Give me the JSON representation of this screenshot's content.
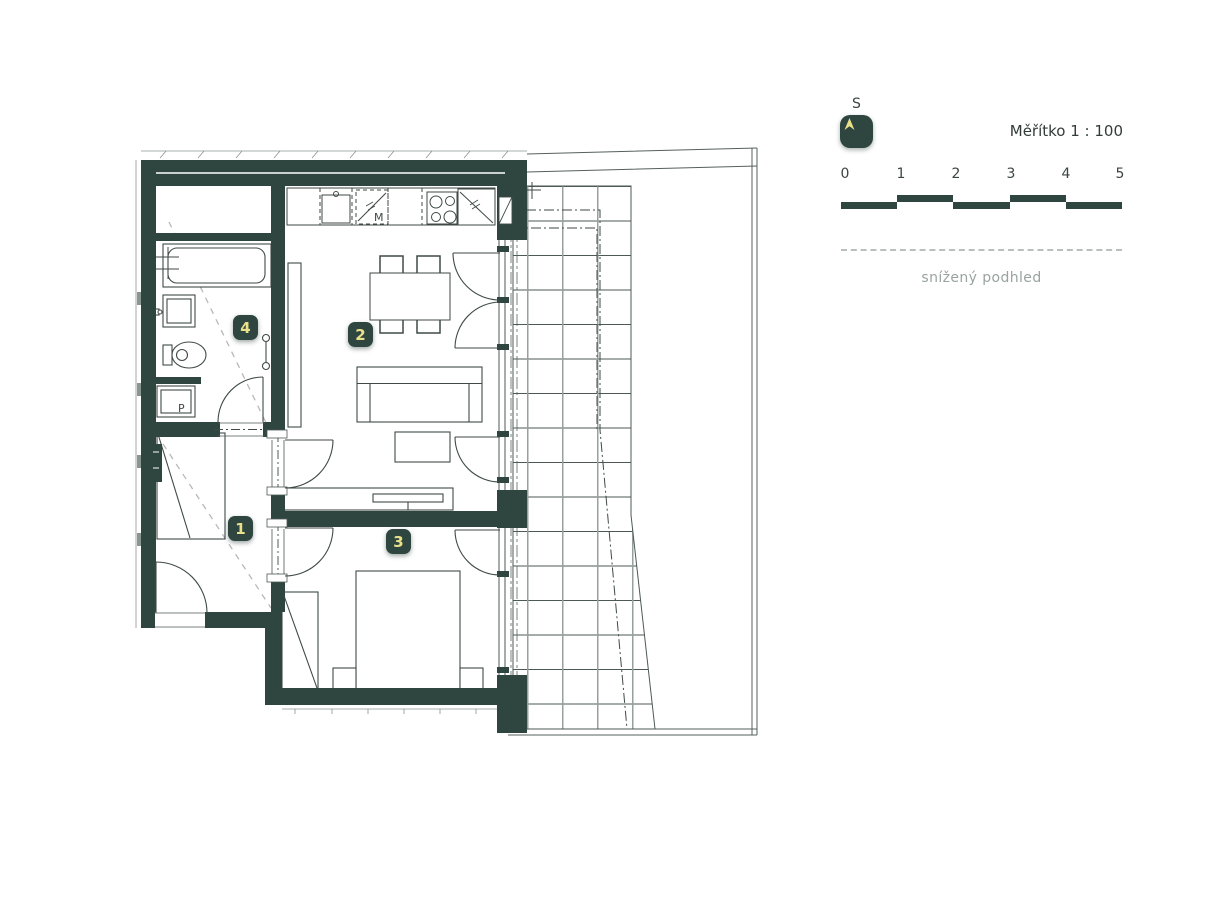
{
  "legend": {
    "north_label": "S",
    "scale_text": "Měřítko 1 : 100",
    "scale_ticks": [
      "0",
      "1",
      "2",
      "3",
      "4",
      "5"
    ],
    "lowered_ceiling_label": "snížený podhled"
  },
  "rooms": [
    {
      "number": "1"
    },
    {
      "number": "2"
    },
    {
      "number": "3"
    },
    {
      "number": "4"
    }
  ],
  "appliances": {
    "dishwasher_label": "M",
    "washing_machine_label": "P"
  },
  "colors": {
    "wall": "#2e463f",
    "badge_text": "#ebe08a",
    "plan_line": "#3f4a46",
    "grid_vertical": "#97a19c",
    "dashed_ceiling_line": "#b8b8b8",
    "muted_text": "#99a49f"
  }
}
